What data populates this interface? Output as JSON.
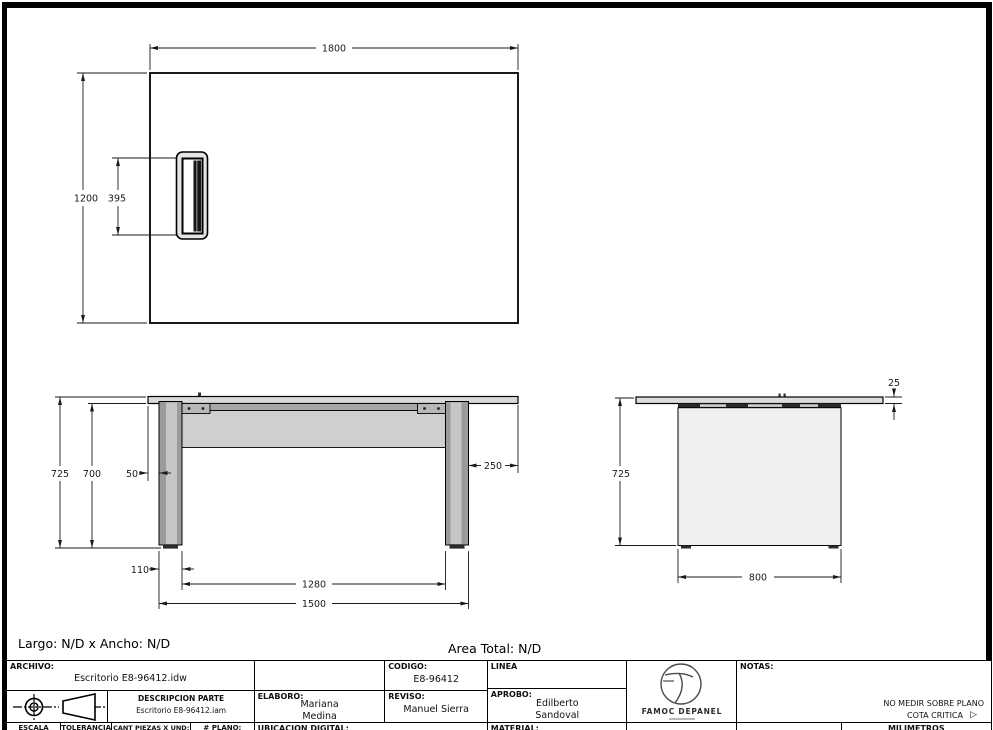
{
  "sheet": {
    "frame_color": "#000000",
    "bg": "#ffffff"
  },
  "summary": {
    "largo_ancho": "Largo: N/D x Ancho: N/D",
    "area_total": "Area Total: N/D"
  },
  "views": {
    "top": {
      "dims": {
        "width": "1800",
        "height": "1200",
        "grommet": "395"
      }
    },
    "front": {
      "dims": {
        "height_total": "725",
        "height_under": "700",
        "left_overhang": "50",
        "right_overhang": "250",
        "leg_width": "110",
        "inner_span": "1280",
        "outer_span": "1500"
      }
    },
    "side": {
      "dims": {
        "top_thickness": "25",
        "height_total": "725",
        "depth": "800"
      }
    }
  },
  "title_block": {
    "archivo": {
      "label": "ARCHIVO:",
      "value": "Escritorio E8-96412.idw"
    },
    "codigo": {
      "label": "CODIGO:",
      "value": "E8-96412"
    },
    "linea": {
      "label": "LINEA"
    },
    "descripcion": {
      "label": "DESCRIPCION PARTE",
      "value": "Escritorio E8-96412.iam"
    },
    "elaboro": {
      "label": "ELABORO:",
      "first": "Mariana",
      "last": "Medina"
    },
    "reviso": {
      "label": "REVISO:",
      "value": "Manuel Sierra"
    },
    "aprobo": {
      "label": "APROBO:",
      "first": "Edilberto",
      "last": "Sandoval"
    },
    "logo": {
      "brand": "FAMOC DEPANEL"
    },
    "notas": {
      "label": "NOTAS:",
      "no_medir": "NO MEDIR SOBRE PLANO",
      "cota_critica": "COTA CRITICA",
      "cota_mark": "▷"
    },
    "escala": "ESCALA",
    "tolerancia": "TOLERANCIA",
    "cant_piezas": "CANT PIEZAS X UND:",
    "plano": "# PLANO:",
    "ubicacion": "UBICACION DIGITAL:",
    "material": "MATERIAL:",
    "milimetros": "MILIMETROS"
  }
}
